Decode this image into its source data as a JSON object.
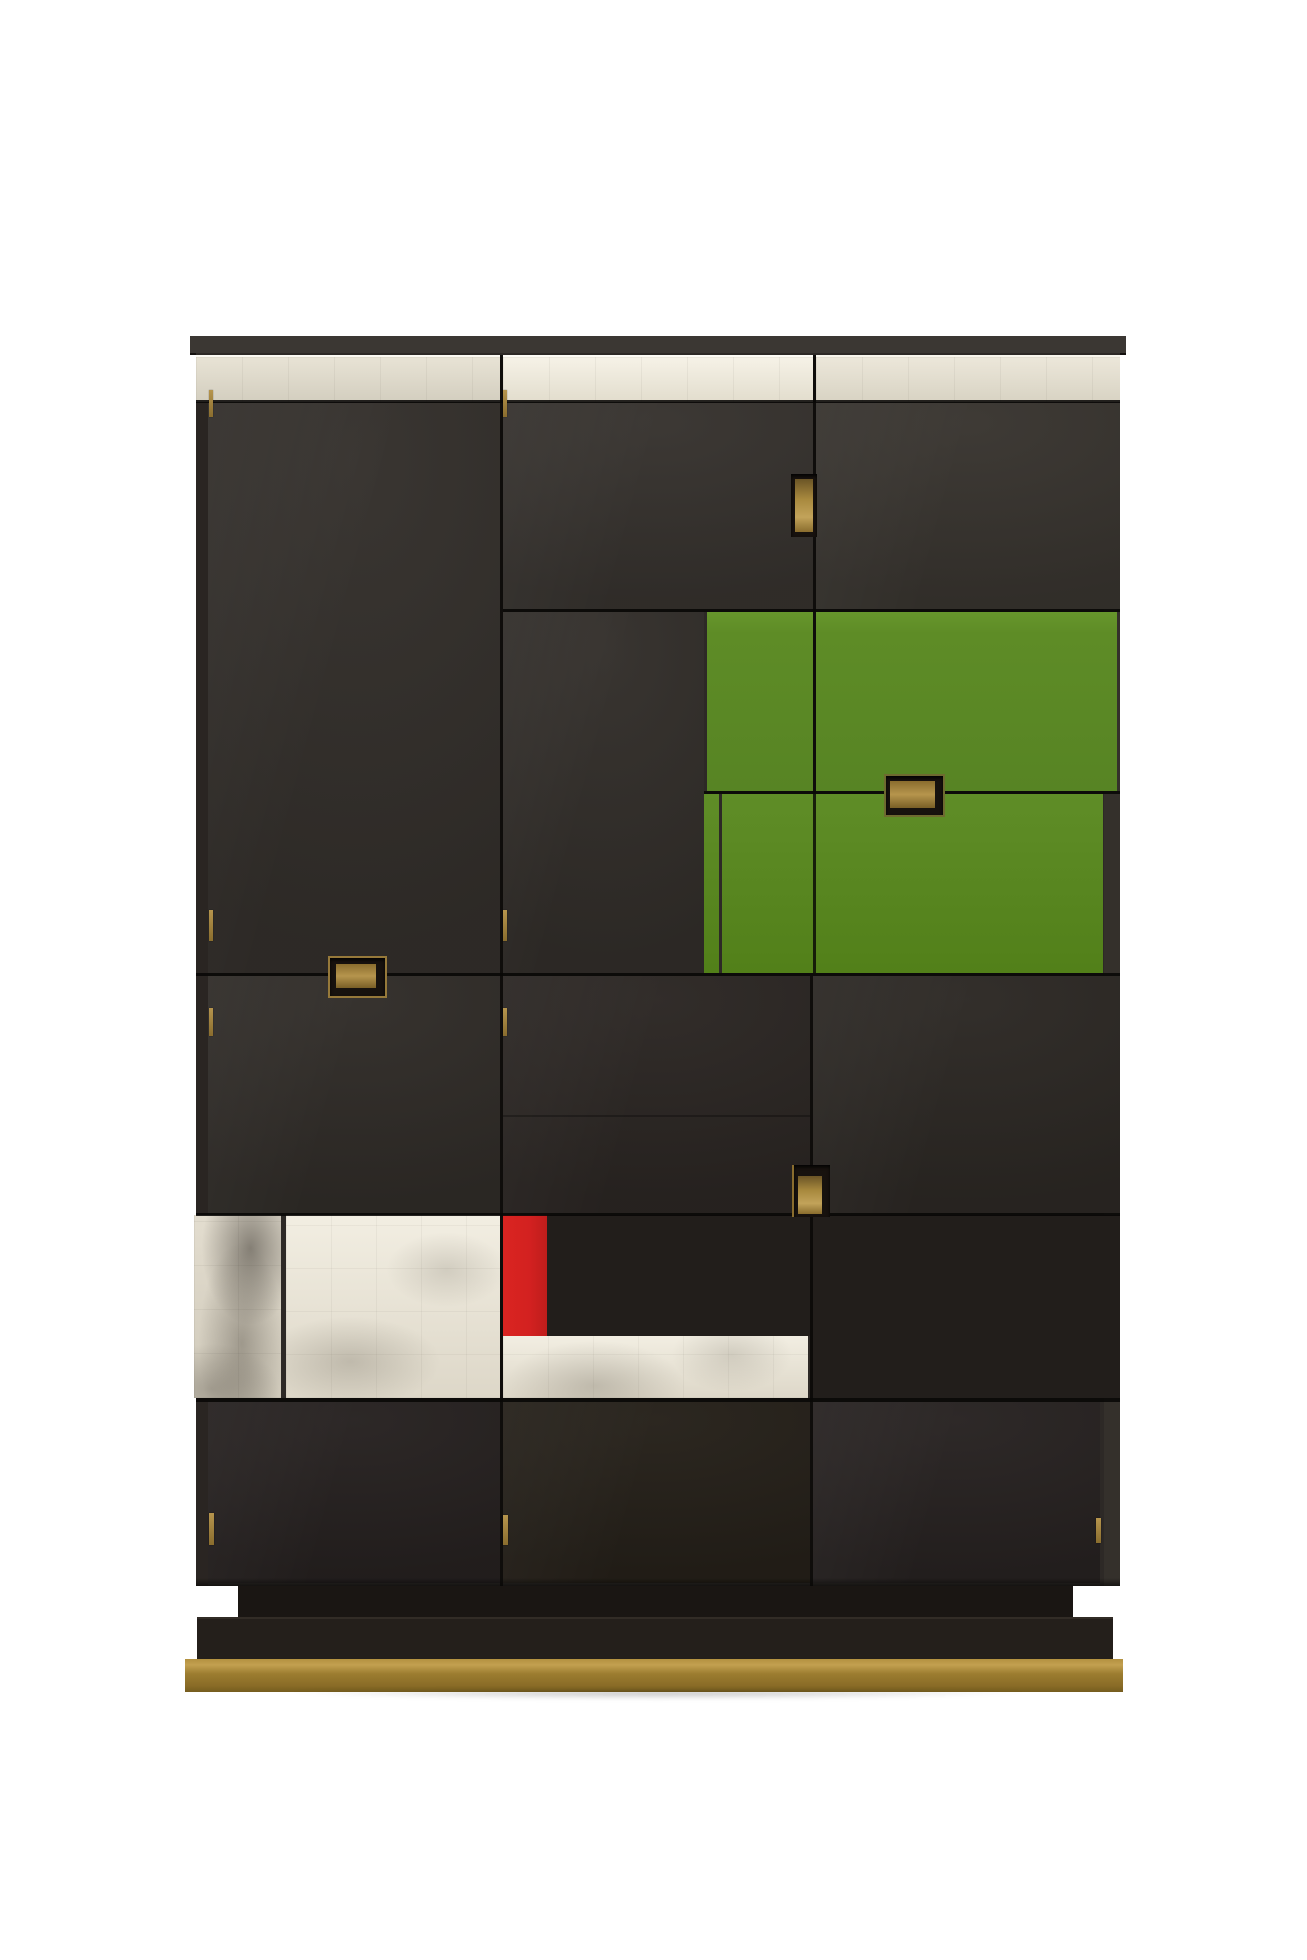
{
  "scene": {
    "description": "Product photograph of a tall modernist cabinet on a white background. Dark stained-wood doors arranged in an asymmetric grid with silver-leaf panels, two green lacquered panels, one red lacquered stripe, recessed brass pulls, brass hinge pins, a stepped dark plinth and a brass base strip.",
    "background": "#ffffff"
  },
  "palette": {
    "background": "#ffffff",
    "wood_top": "#3b3733",
    "wood_body": "#2d2926",
    "wood_door_upper": "#36322e",
    "wood_door_left": "#332f2b",
    "wood_door_mid": "#322e2a",
    "wood_door_lower": "#2b2623",
    "wood_door_bottom": "#262120",
    "wood_dark_block": "#221e1b",
    "plinth_step": "#1a1613",
    "plinth": "#241f1b",
    "green_upper": "#5e8c26",
    "green_lower": "#57851f",
    "red_accent": "#d32120",
    "silver_bright": "#f3efe4",
    "silver_mid": "#e9e4d7",
    "silver_grey": "#d8d3c6",
    "brass": "#a8893e",
    "brass_dark": "#6b5526",
    "brass_base_top": "#b39140",
    "brass_base_face": "#9c7d30",
    "recess_dark": "#17120e"
  },
  "furniture": {
    "type": "cabinet",
    "parts": [
      "top-board",
      "silver-leaf-top-band-left",
      "silver-leaf-top-band-center",
      "silver-leaf-top-band-right",
      "upper-left-tall-door",
      "upper-center-door",
      "upper-right-door",
      "green-panel-small",
      "green-panel-large",
      "green-fall-front-drawer",
      "middle-left-door",
      "lower-center-door",
      "lower-right-door",
      "silver-leaf-panel-narrow",
      "silver-leaf-panel-wide",
      "red-accent-stripe",
      "silver-leaf-band-low",
      "bottom-left-door",
      "bottom-center-door",
      "bottom-right-door",
      "recessed-plinth-step",
      "plinth",
      "brass-base-strip"
    ],
    "handles": [
      "center-top-recessed-pull",
      "green-recessed-pull",
      "left-recessed-pull",
      "center-lower-recessed-pull"
    ],
    "hinge_pins": 9
  }
}
